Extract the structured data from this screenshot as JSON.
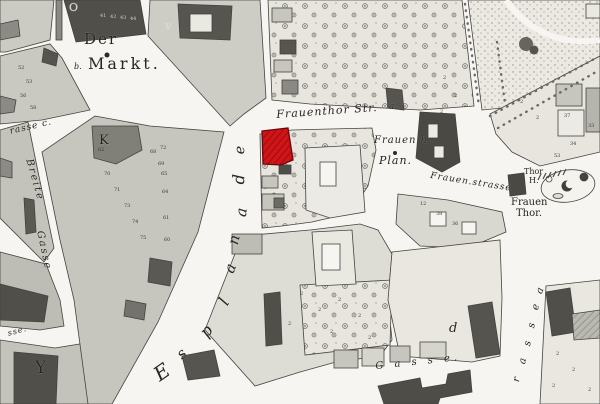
{
  "map": {
    "description": "scanned historical town map with one building highlighted in red",
    "colors": {
      "paper": "#f6f5f1",
      "block_light": "#d9d8d1",
      "block_mid": "#c6c5be",
      "building_dark": "#504f4a",
      "outline": "#44433e",
      "highlight_red": "#d01418",
      "highlight_red_hatch": "#8c0b0e"
    },
    "highlighted_building": {
      "fill": "#d01418",
      "location": "north-west corner of the block on Frauenthor Str."
    }
  },
  "labels": [
    {
      "name": "label-der",
      "text": "Der",
      "x": 84,
      "y": 32,
      "rot": 0,
      "fs": 15,
      "ls": 2,
      "upright": true
    },
    {
      "name": "label-markt",
      "text": "Markt.",
      "x": 88,
      "y": 56,
      "rot": 0,
      "fs": 16,
      "ls": 3,
      "upright": true
    },
    {
      "name": "label-markt-b",
      "text": "b.",
      "x": 74,
      "y": 63,
      "rot": 0,
      "fs": 8,
      "ls": 0
    },
    {
      "name": "label-frauenthor-str",
      "text": "Frauenthor Str.",
      "x": 276,
      "y": 109,
      "rot": -4,
      "fs": 11,
      "ls": 1
    },
    {
      "name": "label-block-a-north",
      "text": "a.",
      "x": 389,
      "y": 103,
      "rot": 0,
      "fs": 9,
      "ls": 0
    },
    {
      "name": "label-frauen-h",
      "text": "Frauen h.",
      "x": 374,
      "y": 136,
      "rot": 0,
      "fs": 10,
      "ls": 1
    },
    {
      "name": "label-plan",
      "text": "Plan.",
      "x": 379,
      "y": 155,
      "rot": 0,
      "fs": 11,
      "ls": 1
    },
    {
      "name": "label-frauenstrasse",
      "text": "Frauen.strasse.",
      "x": 431,
      "y": 172,
      "rot": 9,
      "fs": 9,
      "ls": 1
    },
    {
      "name": "label-thor-h-1",
      "text": "Thor",
      "x": 524,
      "y": 168,
      "rot": 0,
      "fs": 8,
      "ls": 0,
      "upright": true
    },
    {
      "name": "label-thor-h-2",
      "text": "H.",
      "x": 529,
      "y": 177,
      "rot": 0,
      "fs": 8,
      "ls": 0,
      "upright": true
    },
    {
      "name": "label-frauen-thor-1",
      "text": "Frauen",
      "x": 511,
      "y": 198,
      "rot": 0,
      "fs": 10,
      "ls": 0,
      "upright": true
    },
    {
      "name": "label-frauen-thor-2",
      "text": "Thor.",
      "x": 516,
      "y": 209,
      "rot": 0,
      "fs": 10,
      "ls": 0,
      "upright": true
    },
    {
      "name": "label-esplanade-e1",
      "text": "E",
      "x": 150,
      "y": 368,
      "rot": -35,
      "fs": 20,
      "ls": 0
    },
    {
      "name": "label-esplanade-s",
      "text": "s",
      "x": 174,
      "y": 351,
      "rot": -42,
      "fs": 15,
      "ls": 0
    },
    {
      "name": "label-esplanade-p",
      "text": "p",
      "x": 197,
      "y": 330,
      "rot": -50,
      "fs": 16,
      "ls": 0
    },
    {
      "name": "label-esplanade-l",
      "text": "l",
      "x": 216,
      "y": 300,
      "rot": -60,
      "fs": 16,
      "ls": 0
    },
    {
      "name": "label-esplanade-a1",
      "text": "a",
      "x": 222,
      "y": 270,
      "rot": -70,
      "fs": 15,
      "ls": 0
    },
    {
      "name": "label-esplanade-n",
      "text": "n",
      "x": 226,
      "y": 243,
      "rot": -78,
      "fs": 15,
      "ls": 0
    },
    {
      "name": "label-esplanade-a2",
      "text": "a",
      "x": 234,
      "y": 216,
      "rot": -84,
      "fs": 15,
      "ls": 0
    },
    {
      "name": "label-esplanade-d",
      "text": "d",
      "x": 231,
      "y": 184,
      "rot": -88,
      "fs": 16,
      "ls": 0
    },
    {
      "name": "label-esplanade-e2",
      "text": "e",
      "x": 233,
      "y": 154,
      "rot": -88,
      "fs": 14,
      "ls": 0
    },
    {
      "name": "label-breite",
      "text": "Breite",
      "x": 33,
      "y": 158,
      "rot": 74,
      "fs": 10,
      "ls": 2
    },
    {
      "name": "label-gasse-west",
      "text": "Gasse",
      "x": 44,
      "y": 230,
      "rot": 78,
      "fs": 10,
      "ls": 2
    },
    {
      "name": "label-rasse-fragment",
      "text": "rasse c.",
      "x": 9,
      "y": 128,
      "rot": -13,
      "fs": 9,
      "ls": 1
    },
    {
      "name": "label-sse-fragment",
      "text": "sse.",
      "x": 7,
      "y": 330,
      "rot": -15,
      "fs": 8,
      "ls": 1
    },
    {
      "name": "label-gasse-bottom",
      "text": "G a s s e.",
      "x": 375,
      "y": 362,
      "rot": -6,
      "fs": 10,
      "ls": 4
    },
    {
      "name": "label-rasse-vert-r",
      "text": "r",
      "x": 512,
      "y": 381,
      "rot": -78,
      "fs": 10,
      "ls": 0
    },
    {
      "name": "label-rasse-vert-a",
      "text": "a",
      "x": 518,
      "y": 363,
      "rot": -78,
      "fs": 10,
      "ls": 0
    },
    {
      "name": "label-rasse-vert-s1",
      "text": "s",
      "x": 523,
      "y": 345,
      "rot": -78,
      "fs": 10,
      "ls": 0
    },
    {
      "name": "label-rasse-vert-s2",
      "text": "s",
      "x": 527,
      "y": 327,
      "rot": -78,
      "fs": 10,
      "ls": 0
    },
    {
      "name": "label-rasse-vert-e",
      "text": "e",
      "x": 531,
      "y": 309,
      "rot": -78,
      "fs": 10,
      "ls": 0
    },
    {
      "name": "label-block-a-east",
      "text": "a",
      "x": 535,
      "y": 292,
      "rot": -70,
      "fs": 10,
      "ls": 0
    },
    {
      "name": "label-block-d",
      "text": "d",
      "x": 449,
      "y": 322,
      "rot": 0,
      "fs": 13,
      "ls": 0
    },
    {
      "name": "label-block-y",
      "text": "Y",
      "x": 35,
      "y": 360,
      "rot": 0,
      "fs": 17,
      "ls": 0,
      "upright": true
    },
    {
      "name": "label-block-k",
      "text": "K",
      "x": 99,
      "y": 134,
      "rot": 0,
      "fs": 13,
      "ls": 0,
      "upright": true,
      "color": "#1f1e1a"
    },
    {
      "name": "label-block-o",
      "text": "O",
      "x": 69,
      "y": 2,
      "rot": 0,
      "fs": 11,
      "ls": 0,
      "upright": true,
      "color": "#d8d7d1"
    },
    {
      "name": "label-block-v",
      "text": "V",
      "x": 165,
      "y": 24,
      "rot": 0,
      "fs": 9,
      "ls": 0,
      "upright": true,
      "color": "#d8d7d1"
    }
  ],
  "parcel_numbers": [
    {
      "x": 100,
      "y": 14,
      "t": "41",
      "c": "#cfcec8"
    },
    {
      "x": 110,
      "y": 15,
      "t": "42",
      "c": "#cfcec8"
    },
    {
      "x": 120,
      "y": 16,
      "t": "43",
      "c": "#cfcec8"
    },
    {
      "x": 130,
      "y": 17,
      "t": "44",
      "c": "#cfcec8"
    },
    {
      "x": 18,
      "y": 66,
      "t": "52"
    },
    {
      "x": 26,
      "y": 80,
      "t": "53"
    },
    {
      "x": 20,
      "y": 94,
      "t": "56"
    },
    {
      "x": 30,
      "y": 106,
      "t": "58"
    },
    {
      "x": 104,
      "y": 172,
      "t": "70"
    },
    {
      "x": 114,
      "y": 188,
      "t": "71"
    },
    {
      "x": 124,
      "y": 204,
      "t": "73"
    },
    {
      "x": 132,
      "y": 220,
      "t": "74"
    },
    {
      "x": 140,
      "y": 236,
      "t": "75"
    },
    {
      "x": 150,
      "y": 150,
      "t": "68"
    },
    {
      "x": 158,
      "y": 162,
      "t": "69"
    },
    {
      "x": 98,
      "y": 148,
      "t": "62"
    },
    {
      "x": 160,
      "y": 146,
      "t": "72"
    },
    {
      "x": 161,
      "y": 172,
      "t": "65"
    },
    {
      "x": 162,
      "y": 190,
      "t": "64"
    },
    {
      "x": 163,
      "y": 216,
      "t": "61"
    },
    {
      "x": 164,
      "y": 238,
      "t": "60"
    },
    {
      "x": 420,
      "y": 202,
      "t": "12"
    },
    {
      "x": 436,
      "y": 212,
      "t": "38"
    },
    {
      "x": 452,
      "y": 222,
      "t": "36"
    },
    {
      "x": 564,
      "y": 114,
      "t": "37"
    },
    {
      "x": 588,
      "y": 124,
      "t": "33"
    },
    {
      "x": 570,
      "y": 142,
      "t": "34"
    },
    {
      "x": 554,
      "y": 154,
      "t": "53"
    },
    {
      "x": 300,
      "y": 292,
      "t": "2"
    },
    {
      "x": 318,
      "y": 308,
      "t": "2"
    },
    {
      "x": 338,
      "y": 298,
      "t": "2"
    },
    {
      "x": 358,
      "y": 314,
      "t": "2"
    },
    {
      "x": 288,
      "y": 322,
      "t": "2"
    },
    {
      "x": 330,
      "y": 330,
      "t": "2"
    },
    {
      "x": 368,
      "y": 336,
      "t": "2"
    },
    {
      "x": 443,
      "y": 76,
      "t": "2"
    },
    {
      "x": 454,
      "y": 94,
      "t": "2"
    },
    {
      "x": 440,
      "y": 110,
      "t": "2"
    },
    {
      "x": 520,
      "y": 100,
      "t": "2"
    },
    {
      "x": 536,
      "y": 116,
      "t": "2"
    },
    {
      "x": 556,
      "y": 352,
      "t": "2"
    },
    {
      "x": 572,
      "y": 368,
      "t": "2"
    },
    {
      "x": 552,
      "y": 384,
      "t": "2"
    },
    {
      "x": 588,
      "y": 388,
      "t": "2"
    }
  ]
}
